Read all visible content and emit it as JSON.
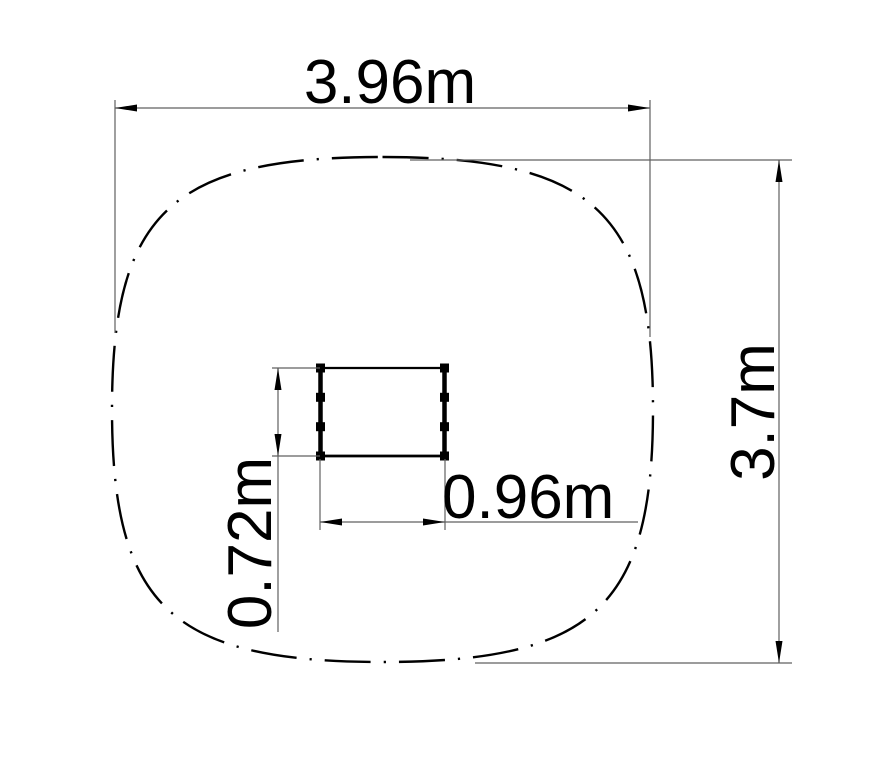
{
  "page": {
    "background_color": "#ffffff",
    "line_color": "#000000",
    "dim_line_color": "#606060"
  },
  "drawing": {
    "kind": "technical plan drawing",
    "dimensions": {
      "overall_width": {
        "label": "3.96m"
      },
      "overall_height": {
        "label": "3.7m"
      },
      "equipment_width": {
        "label": "0.96m"
      },
      "equipment_height": {
        "label": "0.72m"
      }
    }
  }
}
